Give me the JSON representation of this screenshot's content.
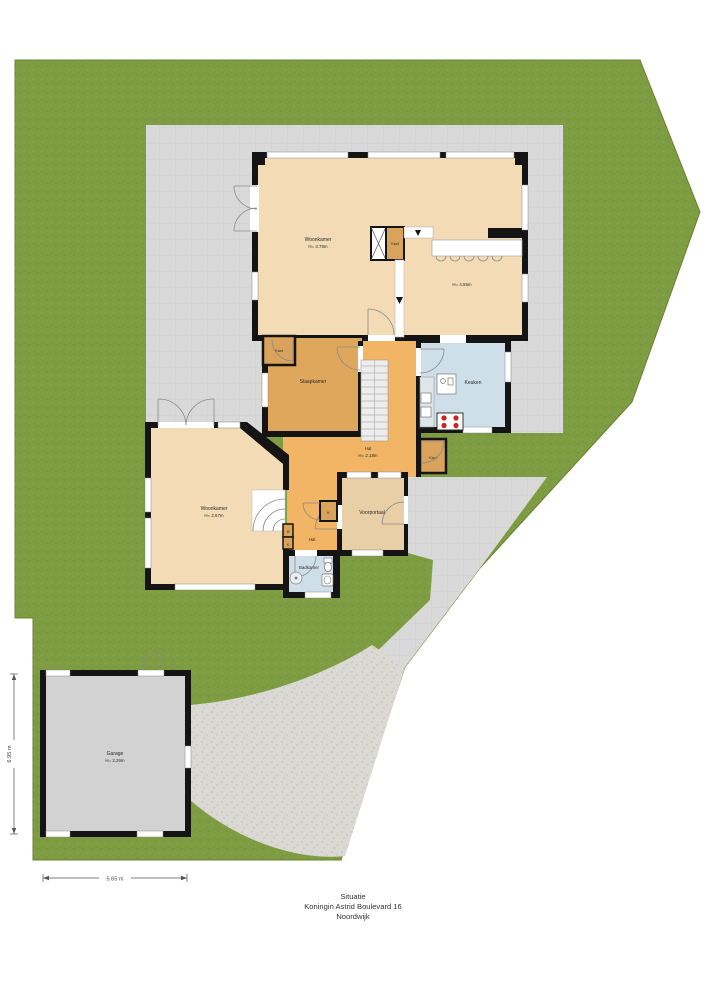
{
  "caption": {
    "title": "Situatie",
    "address": "Koningin Astrid Boulevard 16",
    "city": "Noordwijk"
  },
  "rooms": {
    "living_upper": {
      "name": "Woonkamer",
      "height": "H= 3.79m"
    },
    "dining": {
      "height": "H= 4.55m"
    },
    "closet_top": {
      "name": "Kast"
    },
    "closet_room": {
      "name": "Kast"
    },
    "closet_mid": {
      "name": "Kast"
    },
    "bedroom": {
      "name": "Slaapkamer"
    },
    "kitchen": {
      "name": "Keuken"
    },
    "hall_mid": {
      "name": "Hal",
      "height": "H= 2.18m"
    },
    "living_lower": {
      "name": "Woonkamer",
      "height": "H= 2.67m"
    },
    "vestibule": {
      "name": "Voorportaal"
    },
    "hall_lower": {
      "name": "Hal"
    },
    "bathroom": {
      "name": "Badkamer"
    },
    "meter_closet": {
      "name": "M"
    },
    "closet_k": {
      "name": "K"
    },
    "garage": {
      "name": "Garage",
      "height": "H= 2.29m"
    }
  },
  "dimensions": {
    "garage_width": "5.65 m",
    "garage_depth": "6.95 m"
  },
  "colors": {
    "grass": "#7e9c42",
    "paving": "#d9d9d9",
    "path": "#dbd9d3",
    "garage": "#d2d2d2",
    "floor_tan": "#f2dbb5",
    "vestibule": "#e9cfa6",
    "bedroom": "#dfa75c",
    "hall": "#f2b566",
    "closet": "#d9a35b",
    "wet_blue": "#cfdfe9",
    "wall": "#141414"
  }
}
